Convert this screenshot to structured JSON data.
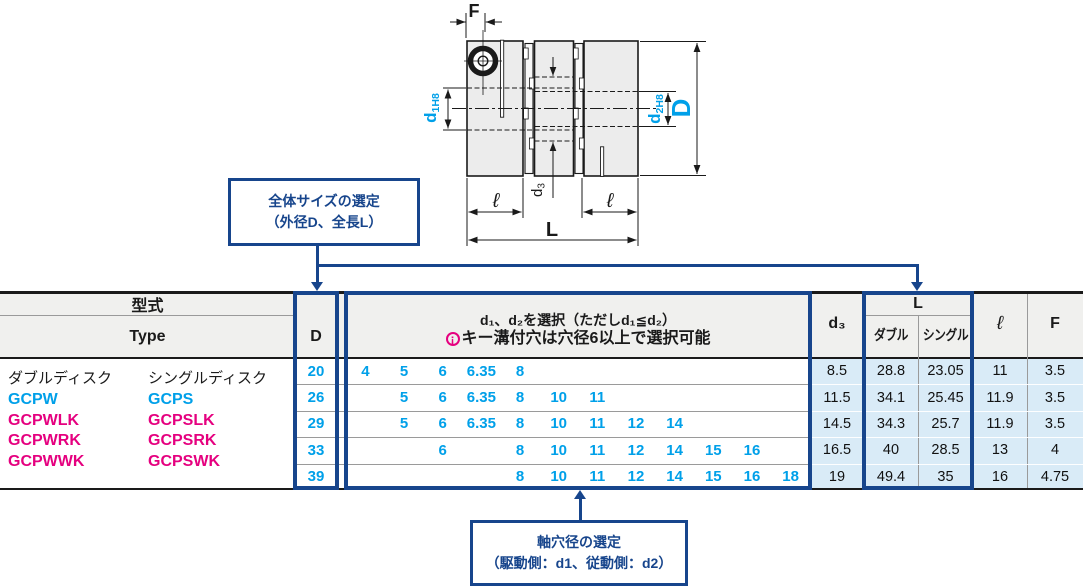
{
  "drawing": {
    "labels": {
      "f": "F",
      "d": "D",
      "l_total": "L",
      "ell": "ℓ",
      "d1_main": "d",
      "d1_sub": "1H8",
      "d2_main": "d",
      "d2_sub": "2H8",
      "d3_main": "d",
      "d3_sub": "3"
    }
  },
  "callouts": {
    "size": {
      "line1": "全体サイズの選定",
      "line2": "（外径D、全長L）"
    },
    "bore": {
      "line1": "軸穴径の選定",
      "line2": "（駆動側：d1、従動側：d2）"
    }
  },
  "icons": {
    "point_icon": "¡"
  },
  "table": {
    "header": {
      "model": "型式",
      "model_en": "Type",
      "d": "D",
      "d1d2_line1": "d₁、d₂を選択（ただしd₁≦d₂）",
      "d1d2_line2": "キー溝付穴は穴径6以上で選択可能",
      "d3": "d₃",
      "l_group": "L",
      "l_double": "ダブル",
      "l_single": "シングル",
      "ell": "ℓ",
      "f": "F"
    },
    "type_column": {
      "double": [
        "ダブルディスク",
        "GCPW",
        "GCPWLK",
        "GCPWRK",
        "GCPWWK"
      ],
      "single": [
        "シングルディスク",
        "GCPS",
        "GCPSLK",
        "GCPSRK",
        "GCPSWK"
      ]
    },
    "rows": [
      {
        "D": "20",
        "d1d2": [
          "4",
          "5",
          "6",
          "6.35",
          "8",
          "",
          "",
          "",
          "",
          "",
          "",
          ""
        ],
        "d3": "8.5",
        "l_double": "28.8",
        "l_single": "23.05",
        "ell": "11",
        "f": "3.5"
      },
      {
        "D": "26",
        "d1d2": [
          "",
          "5",
          "6",
          "6.35",
          "8",
          "10",
          "11",
          "",
          "",
          "",
          "",
          ""
        ],
        "d3": "11.5",
        "l_double": "34.1",
        "l_single": "25.45",
        "ell": "11.9",
        "f": "3.5"
      },
      {
        "D": "29",
        "d1d2": [
          "",
          "5",
          "6",
          "6.35",
          "8",
          "10",
          "11",
          "12",
          "14",
          "",
          "",
          ""
        ],
        "d3": "14.5",
        "l_double": "34.3",
        "l_single": "25.7",
        "ell": "11.9",
        "f": "3.5"
      },
      {
        "D": "33",
        "d1d2": [
          "",
          "",
          "6",
          "",
          "8",
          "10",
          "11",
          "12",
          "14",
          "15",
          "16",
          ""
        ],
        "d3": "16.5",
        "l_double": "40",
        "l_single": "28.5",
        "ell": "13",
        "f": "4"
      },
      {
        "D": "39",
        "d1d2": [
          "",
          "",
          "",
          "",
          "8",
          "10",
          "11",
          "12",
          "14",
          "15",
          "16",
          "18"
        ],
        "d3": "19",
        "l_double": "49.4",
        "l_single": "35",
        "ell": "16",
        "f": "4.75"
      }
    ]
  },
  "colors": {
    "accent_cyan": "#00a0e9",
    "magenta": "#e5007f",
    "navy": "#17458c",
    "row_blue": "#d9ebf7"
  }
}
